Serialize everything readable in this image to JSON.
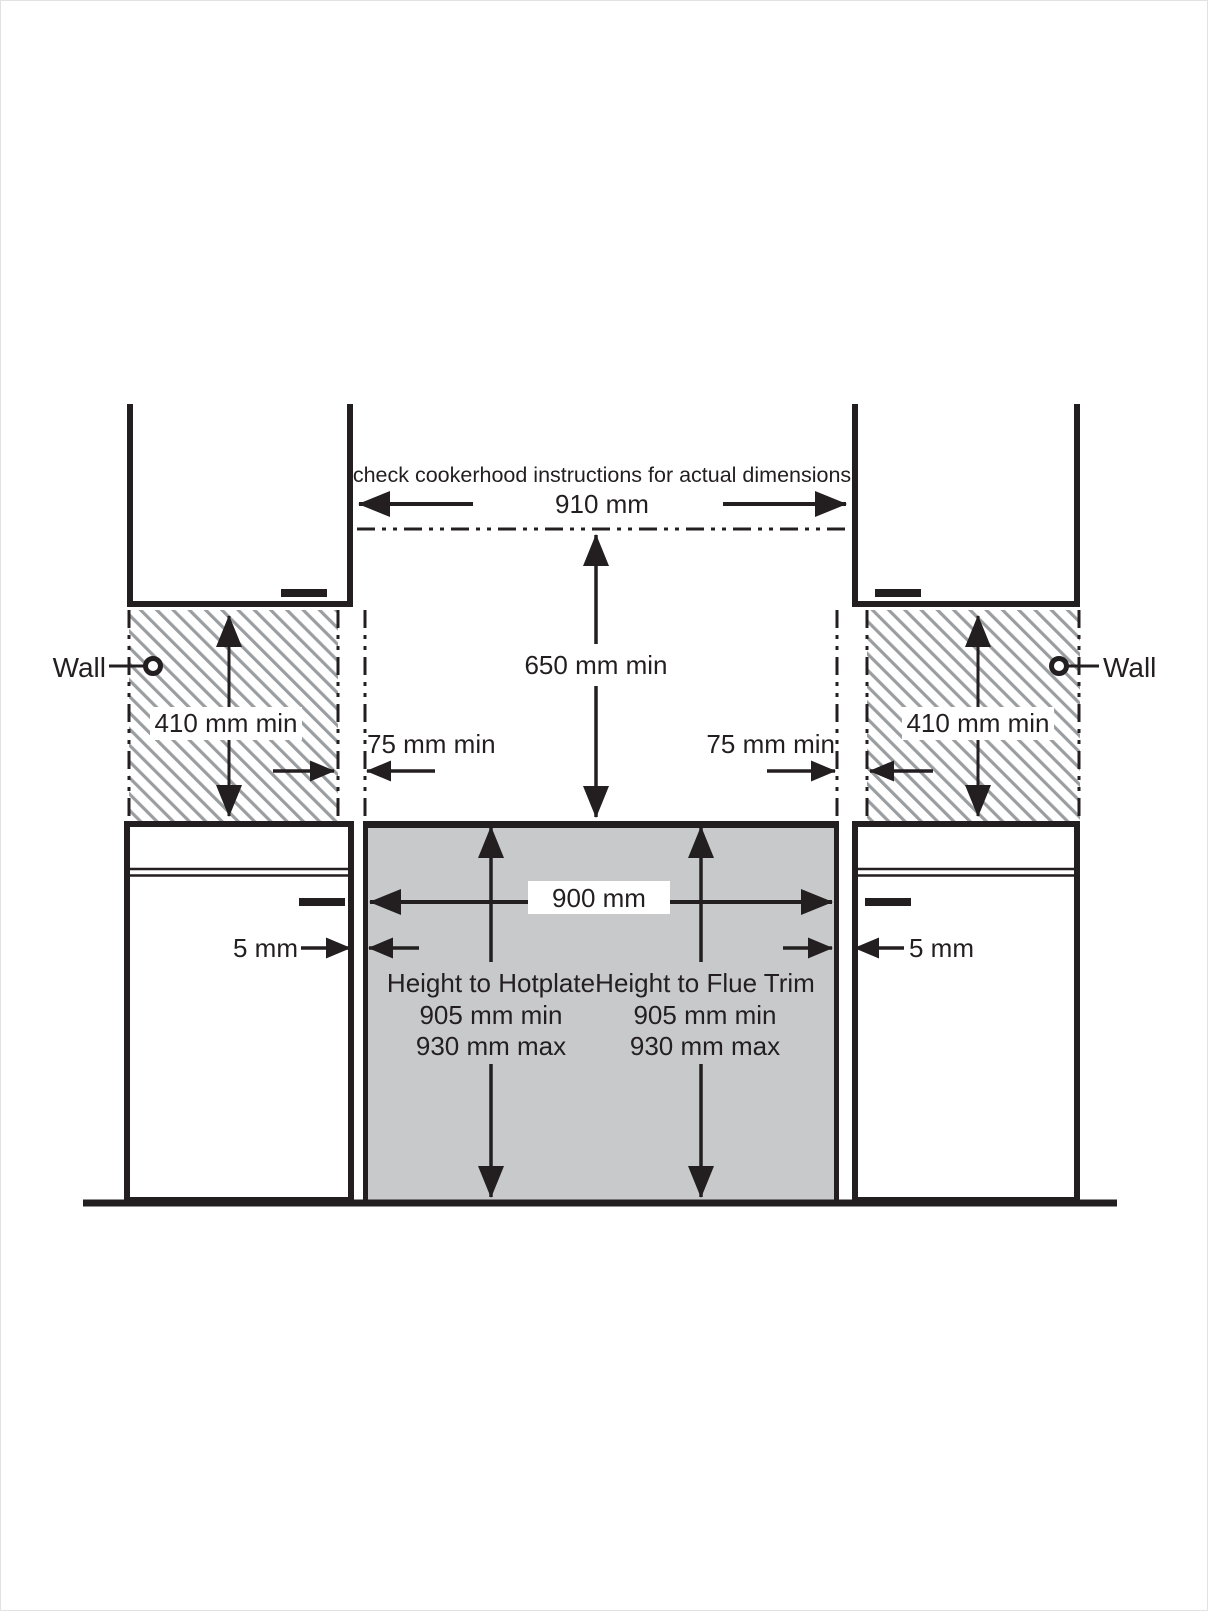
{
  "diagram": {
    "top_note": "check cookerhood instructions for actual dimensions",
    "cookerhood_width": "910 mm",
    "hood_clearance": "650 mm min",
    "wall_left": "Wall",
    "wall_right": "Wall",
    "wall_clearance_left": "410 mm min",
    "wall_clearance_right": "410 mm min",
    "side_clearance_left": "75 mm min",
    "side_clearance_right": "75 mm min",
    "cooker_width": "900 mm",
    "gap_left": "5 mm",
    "gap_right": "5 mm",
    "hotplate": {
      "title": "Height to Hotplate",
      "min": "905 mm min",
      "max": "930 mm max"
    },
    "flue_trim": {
      "title": "Height to Flue Trim",
      "min": "905 mm min",
      "max": "930 mm max"
    },
    "colors": {
      "line": "#231f20",
      "cooker_fill": "#c8c9cb",
      "hatch": "#9b9ea1",
      "label_bg": "#ffffff"
    }
  }
}
